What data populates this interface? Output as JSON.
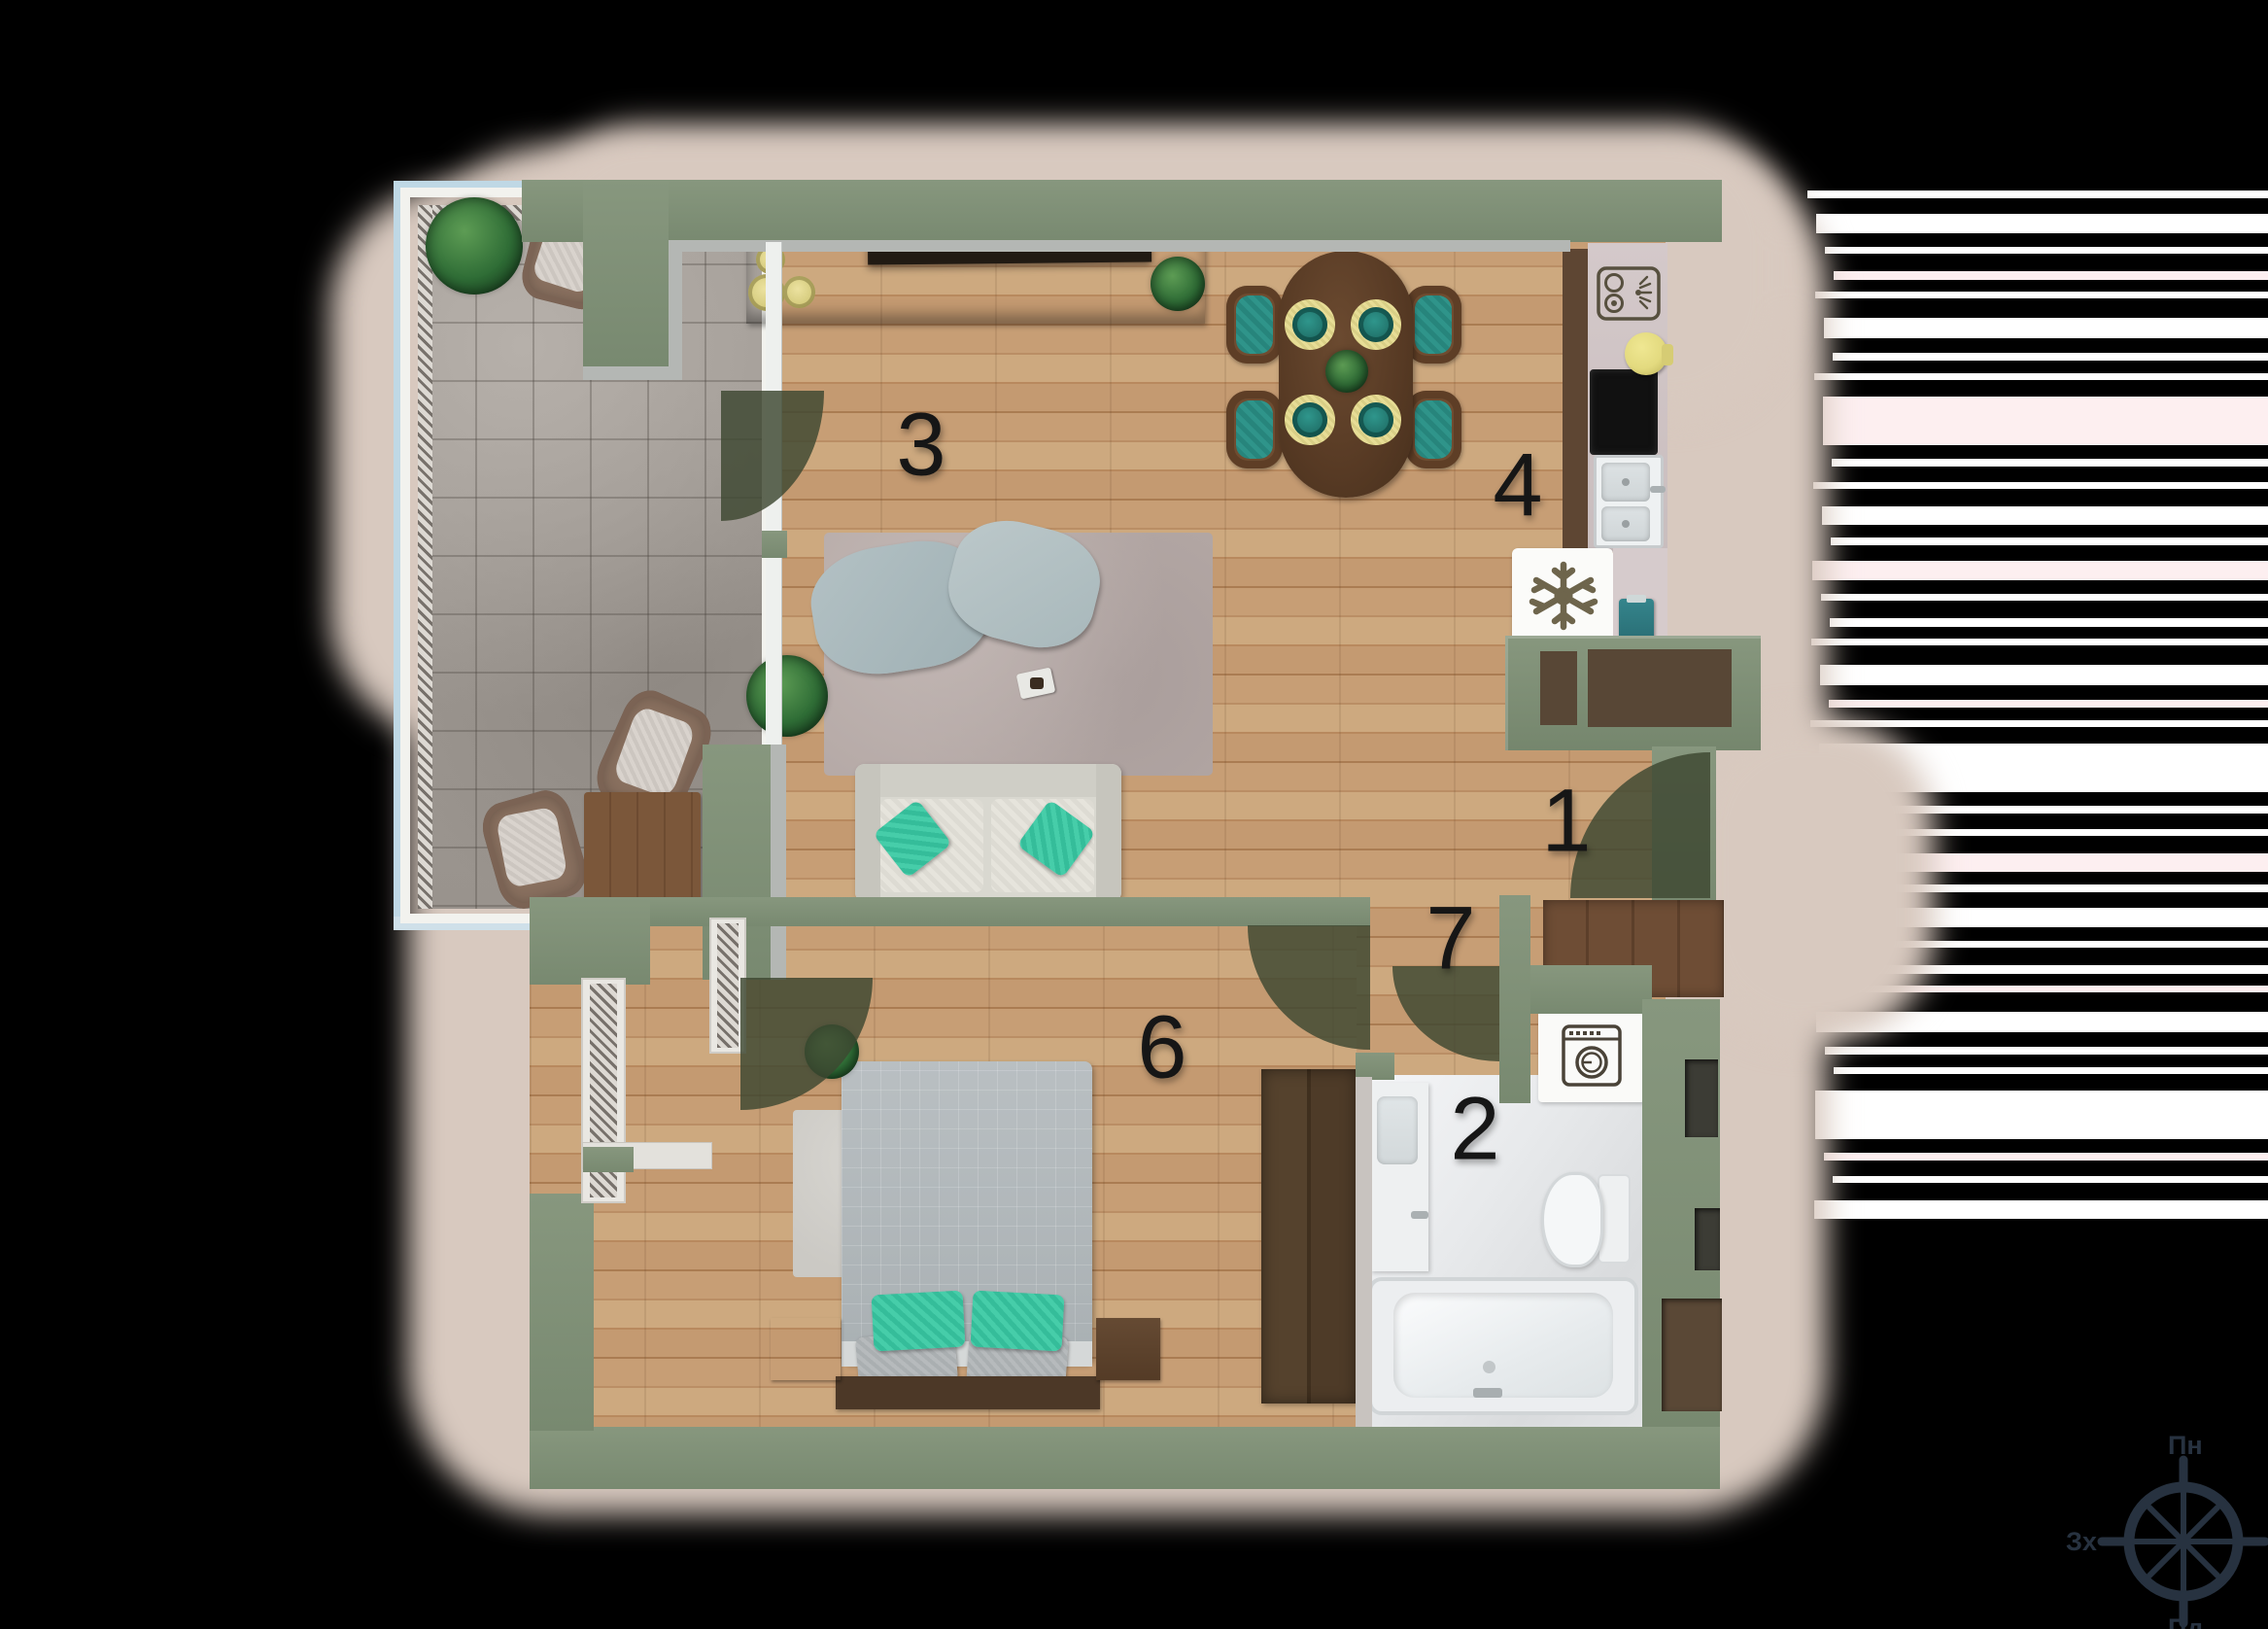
{
  "floorplan": {
    "room_labels": [
      {
        "number": "1"
      },
      {
        "number": "2"
      },
      {
        "number": "3"
      },
      {
        "number": "4"
      },
      {
        "number": "6"
      },
      {
        "number": "7"
      }
    ],
    "compass": {
      "north": "Пн",
      "east": "Сх",
      "south": "Пд",
      "west": "Зх"
    },
    "palette": {
      "background": "#000000",
      "glow": "#d8c9bf",
      "wall_green": "#7e8f75",
      "floor_wood": "#c49a71",
      "floor_tile": "#a19b95",
      "bathroom_floor": "#e3e4e6",
      "accent_teal": "#35bd9a",
      "chair_teal": "#2f948a",
      "bowl_yellow": "#d6cc7e",
      "door_arc": "#3d4731",
      "compass_ink": "#273240",
      "label_ink": "#161616"
    }
  }
}
